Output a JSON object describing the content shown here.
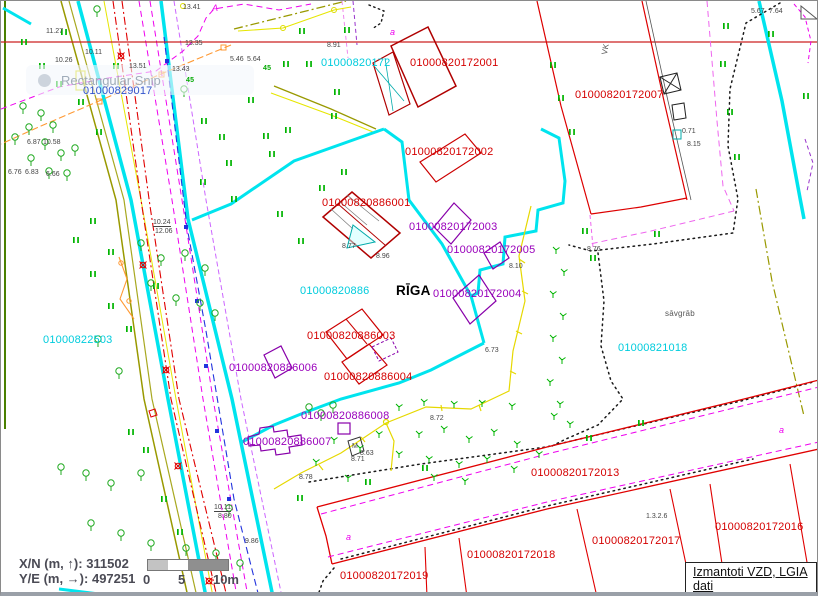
{
  "window": {
    "snip_toast": "Rectangular Snip"
  },
  "colors": {
    "parcel_cyan": "#00ccdd",
    "parcel_blue": "#3355cc",
    "building_red": "#d40000",
    "building_purple": "#9900bb",
    "boundary_cyan": "#00e4ee",
    "street_red": "#e00000",
    "utility_magenta": "#ee00ee",
    "vegetation_green": "#00b400",
    "road_olive": "#999900"
  },
  "map": {
    "city_label": "RĪGA",
    "labels": [
      {
        "n": "parcel-label",
        "t": "01000820172",
        "x": 320,
        "y": 57,
        "c": "cyan"
      },
      {
        "n": "parcel-label",
        "t": "01000820886",
        "x": 299,
        "y": 285,
        "c": "cyan"
      },
      {
        "n": "parcel-label",
        "t": "01000822503",
        "x": 42,
        "y": 334,
        "c": "cyan"
      },
      {
        "n": "parcel-label",
        "t": "01000821018",
        "x": 617,
        "y": 342,
        "c": "cyan"
      },
      {
        "n": "parcel-label",
        "t": "01000829017",
        "x": 82,
        "y": 85,
        "c": "blue"
      },
      {
        "n": "building-label",
        "t": "01000820172001",
        "x": 409,
        "y": 57,
        "c": "red"
      },
      {
        "n": "building-label",
        "t": "01000820172007",
        "x": 574,
        "y": 89,
        "c": "red"
      },
      {
        "n": "building-label",
        "t": "01000820172002",
        "x": 404,
        "y": 146,
        "c": "red"
      },
      {
        "n": "building-label",
        "t": "01000820886001",
        "x": 321,
        "y": 197,
        "c": "red"
      },
      {
        "n": "building-label",
        "t": "01000820886003",
        "x": 306,
        "y": 330,
        "c": "red"
      },
      {
        "n": "building-label",
        "t": "01000820886004",
        "x": 323,
        "y": 371,
        "c": "red"
      },
      {
        "n": "parcel-label",
        "t": "01000820172013",
        "x": 530,
        "y": 467,
        "c": "red"
      },
      {
        "n": "parcel-label",
        "t": "01000820172016",
        "x": 714,
        "y": 521,
        "c": "red"
      },
      {
        "n": "parcel-label",
        "t": "01000820172017",
        "x": 591,
        "y": 535,
        "c": "red"
      },
      {
        "n": "parcel-label",
        "t": "01000820172018",
        "x": 466,
        "y": 549,
        "c": "red"
      },
      {
        "n": "parcel-label",
        "t": "01000820172019",
        "x": 339,
        "y": 570,
        "c": "red"
      },
      {
        "n": "building-label",
        "t": "01000820172003",
        "x": 408,
        "y": 221,
        "c": "purple"
      },
      {
        "n": "building-label",
        "t": "01000820172005",
        "x": 446,
        "y": 244,
        "c": "purple"
      },
      {
        "n": "building-label",
        "t": "01000820172004",
        "x": 432,
        "y": 288,
        "c": "purple"
      },
      {
        "n": "building-label",
        "t": "01000820886006",
        "x": 228,
        "y": 362,
        "c": "purple"
      },
      {
        "n": "building-label",
        "t": "01000820886008",
        "x": 300,
        "y": 410,
        "c": "purple"
      },
      {
        "n": "building-label",
        "t": "01000820886007",
        "x": 242,
        "y": 436,
        "c": "purple"
      },
      {
        "n": "city-label",
        "t": "RĪGA",
        "x": 395,
        "y": 283,
        "c": "black"
      },
      {
        "n": "terrain-label",
        "t": "sāvgrāb",
        "x": 664,
        "y": 309,
        "c": "gray"
      },
      {
        "n": "landuse-code",
        "t": "1.3.2.6",
        "x": 645,
        "y": 512,
        "c": "tiny"
      },
      {
        "n": "utility-label",
        "t": "VK",
        "x": 600,
        "y": 53,
        "c": "gray",
        "r": -80
      },
      {
        "n": "well-label",
        "t": "M",
        "x": 351,
        "y": 442,
        "c": "tiny"
      },
      {
        "n": "spot-height",
        "t": "11.27",
        "x": 45,
        "y": 27,
        "c": "tiny"
      },
      {
        "n": "spot-height",
        "t": "13.35",
        "x": 184,
        "y": 39,
        "c": "tiny"
      },
      {
        "n": "spot-height",
        "t": "10.11",
        "x": 84,
        "y": 48,
        "c": "tiny"
      },
      {
        "n": "spot-height",
        "t": "10.26",
        "x": 54,
        "y": 56,
        "c": "tiny"
      },
      {
        "n": "spot-height",
        "t": "13.43",
        "x": 171,
        "y": 65,
        "c": "tiny"
      },
      {
        "n": "spot-height",
        "t": "13.51",
        "x": 128,
        "y": 62,
        "c": "tiny"
      },
      {
        "n": "spot-height",
        "t": "5.46",
        "x": 229,
        "y": 55,
        "c": "tiny"
      },
      {
        "n": "spot-height",
        "t": "5.64",
        "x": 246,
        "y": 55,
        "c": "tiny"
      },
      {
        "n": "spot-height",
        "t": "8.91",
        "x": 326,
        "y": 41,
        "c": "tiny"
      },
      {
        "n": "spot-height",
        "t": "13.41",
        "x": 182,
        "y": 3,
        "c": "tiny"
      },
      {
        "n": "spot-height",
        "t": "8.77",
        "x": 341,
        "y": 242,
        "c": "tiny"
      },
      {
        "n": "spot-height",
        "t": "8.96",
        "x": 375,
        "y": 252,
        "c": "tiny"
      },
      {
        "n": "spot-height",
        "t": "6.76",
        "x": 7,
        "y": 168,
        "c": "tiny"
      },
      {
        "n": "spot-height",
        "t": "6.83",
        "x": 24,
        "y": 168,
        "c": "tiny"
      },
      {
        "n": "spot-height",
        "t": "6.66",
        "x": 45,
        "y": 170,
        "c": "tiny"
      },
      {
        "n": "spot-height",
        "t": "6.87",
        "x": 26,
        "y": 138,
        "c": "tiny"
      },
      {
        "n": "spot-height",
        "t": "10.58",
        "x": 42,
        "y": 138,
        "c": "tiny"
      },
      {
        "n": "spot-height",
        "t": "8.72",
        "x": 429,
        "y": 414,
        "c": "tiny"
      },
      {
        "n": "spot-height",
        "t": "8.71",
        "x": 350,
        "y": 455,
        "c": "tiny"
      },
      {
        "n": "spot-height",
        "t": "8.63",
        "x": 359,
        "y": 449,
        "c": "tiny"
      },
      {
        "n": "spot-height",
        "t": "0.71",
        "x": 681,
        "y": 127,
        "c": "tiny"
      },
      {
        "n": "spot-height",
        "t": "8.15",
        "x": 686,
        "y": 140,
        "c": "tiny"
      },
      {
        "n": "spot-height",
        "t": "9.86",
        "x": 244,
        "y": 537,
        "c": "tiny"
      },
      {
        "n": "spot-height",
        "t": "8.78",
        "x": 298,
        "y": 473,
        "c": "tiny"
      },
      {
        "n": "spot-height",
        "t": "8.10",
        "x": 508,
        "y": 262,
        "c": "tiny"
      },
      {
        "n": "spot-height",
        "t": "8.76",
        "x": 586,
        "y": 245,
        "c": "tiny"
      },
      {
        "n": "spot-height",
        "t": "6.73",
        "x": 484,
        "y": 346,
        "c": "tiny"
      },
      {
        "n": "spot-height",
        "t": "7.64",
        "x": 768,
        "y": 7,
        "c": "tiny"
      },
      {
        "n": "spot-height",
        "t": "5.67",
        "x": 750,
        "y": 7,
        "c": "tiny"
      },
      {
        "n": "utility-depth",
        "t": "10.24",
        "x": 152,
        "y": 218,
        "c": "tiny",
        "u": 1
      },
      {
        "n": "utility-depth",
        "t": "12.06",
        "x": 154,
        "y": 227,
        "c": "tiny"
      },
      {
        "n": "utility-depth",
        "t": "10.11",
        "x": 213,
        "y": 503,
        "c": "tiny",
        "u": 1
      },
      {
        "n": "utility-depth",
        "t": "8.80",
        "x": 217,
        "y": 512,
        "c": "tiny"
      },
      {
        "n": "landuse-letter",
        "t": "a",
        "x": 389,
        "y": 27,
        "c": "mag"
      },
      {
        "n": "landuse-letter",
        "t": "a",
        "x": 345,
        "y": 532,
        "c": "mag"
      },
      {
        "n": "landuse-letter",
        "t": "a",
        "x": 778,
        "y": 425,
        "c": "mag"
      },
      {
        "n": "landuse-letter",
        "t": "A",
        "x": 211,
        "y": 3,
        "c": "mag"
      },
      {
        "n": "tree-height",
        "t": "45",
        "x": 185,
        "y": 76,
        "c": "green"
      },
      {
        "n": "tree-height",
        "t": "45",
        "x": 262,
        "y": 64,
        "c": "green"
      }
    ]
  },
  "statusbar": {
    "x_label": "X/N (m, ↑):",
    "x_value": "311502",
    "y_label": "Y/E (m, →):",
    "y_value": "497251"
  },
  "scalebar": {
    "tick0": "0",
    "tick5": "5",
    "tick10": "10m"
  },
  "attribution": {
    "text": "Izmantoti VZD, LGIA dati"
  }
}
